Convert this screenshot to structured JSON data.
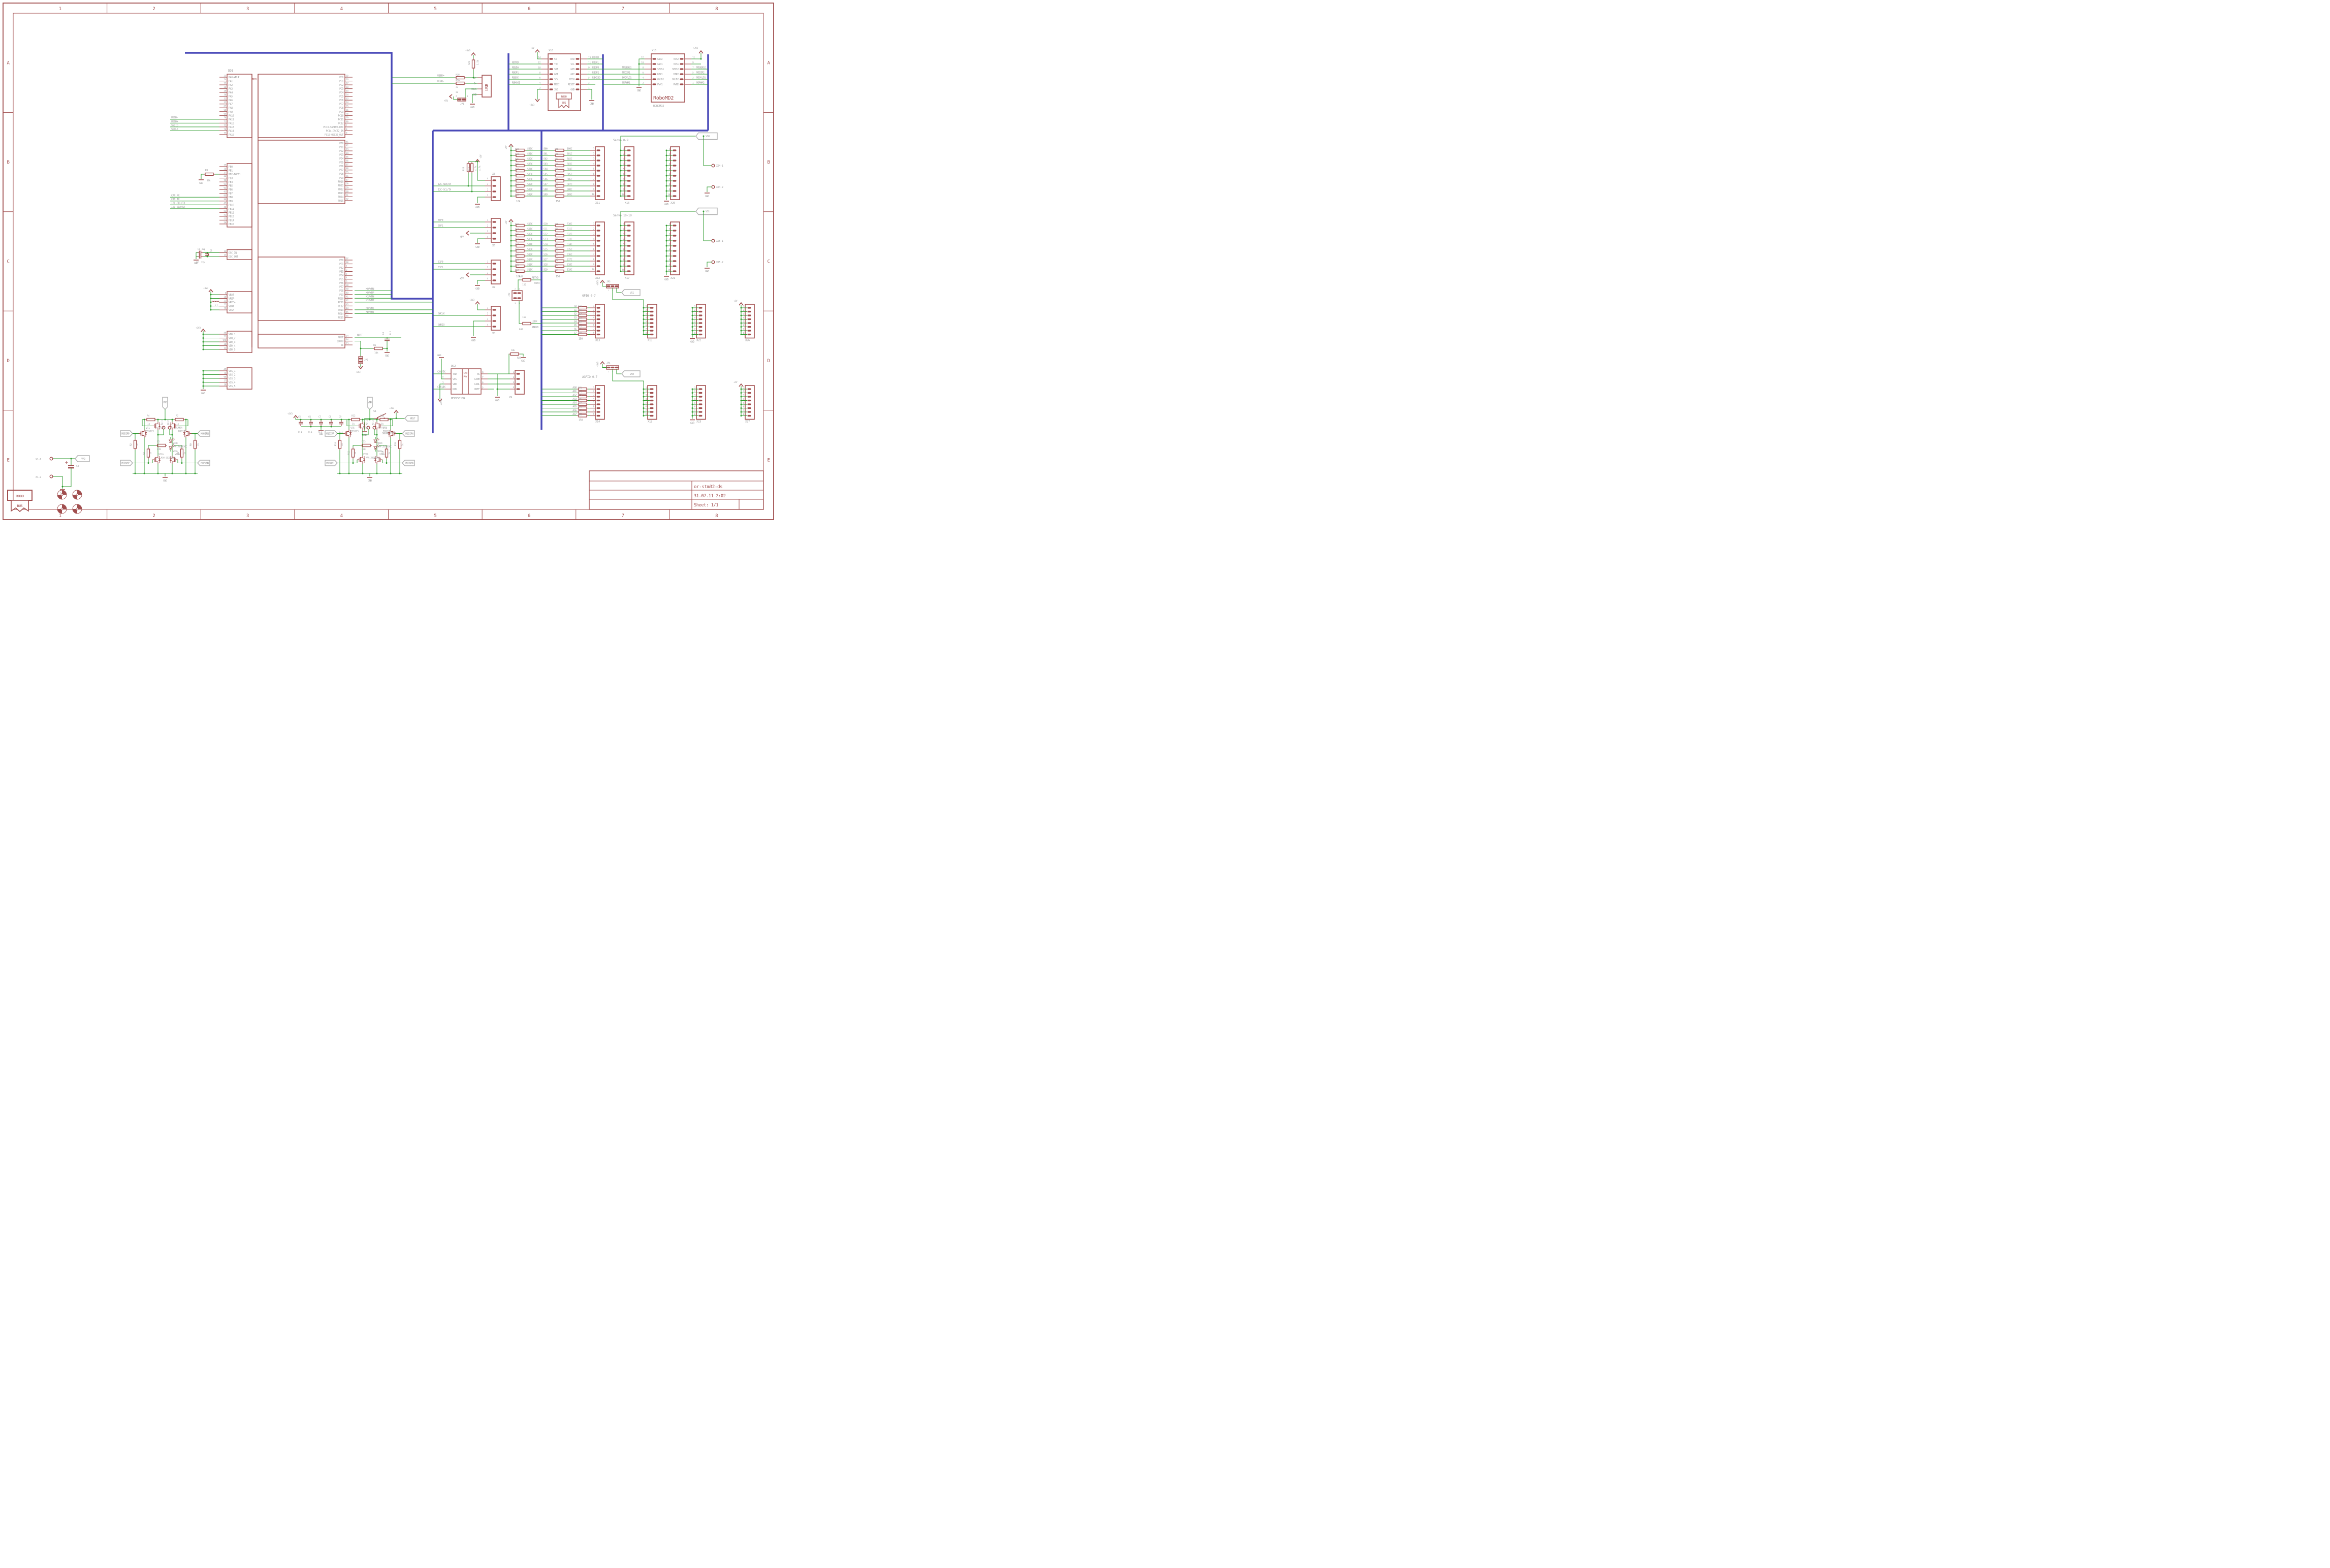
{
  "sym": {
    "gnd": "GND",
    "p5": "+5V",
    "p3": "+3V3",
    "vmd": "VMD"
  },
  "frame": {
    "cols": [
      "1",
      "2",
      "3",
      "4",
      "5",
      "6",
      "7",
      "8"
    ],
    "rows": [
      "A",
      "B",
      "C",
      "D",
      "E"
    ]
  },
  "title_block": {
    "project": "or-stm32-ds",
    "date": "31.07.11 2:02",
    "sheet": "Sheet: 1/1"
  },
  "mcu": {
    "name": "DD1",
    "tag": "MCU",
    "pa": [
      [
        "23",
        "PA0-WKUP",
        ""
      ],
      [
        "24",
        "PA1",
        ""
      ],
      [
        "25",
        "PA2",
        ""
      ],
      [
        "26",
        "PA3",
        ""
      ],
      [
        "29",
        "PA4",
        ""
      ],
      [
        "30",
        "PA5",
        ""
      ],
      [
        "31",
        "PA6",
        ""
      ],
      [
        "32",
        "PA7",
        ""
      ],
      [
        "67",
        "PA8",
        ""
      ],
      [
        "68",
        "PA9",
        ""
      ],
      [
        "69",
        "PA10",
        ""
      ],
      [
        "70",
        "PA11",
        "USBD-"
      ],
      [
        "71",
        "PA12",
        "USBD+"
      ],
      [
        "72",
        "PA13",
        "SWDIO"
      ],
      [
        "76",
        "PA14",
        "SWCLK"
      ],
      [
        "77",
        "PA15",
        ""
      ]
    ],
    "pb": [
      [
        "35",
        "PB0",
        ""
      ],
      [
        "36",
        "PB1",
        ""
      ],
      [
        "37",
        "PB2-BOOT1",
        ""
      ],
      [
        "89",
        "PB3",
        ""
      ],
      [
        "90",
        "PB4",
        ""
      ],
      [
        "91",
        "PB5",
        ""
      ],
      [
        "92",
        "PB6",
        ""
      ],
      [
        "93",
        "PB7",
        ""
      ],
      [
        "95",
        "PB8",
        "CAN_RX"
      ],
      [
        "96",
        "PB9",
        "CAN_TX"
      ],
      [
        "47",
        "PB10",
        "I2C-SCL/TX"
      ],
      [
        "48",
        "PB11",
        "I2C-SDA/RX"
      ],
      [
        "51",
        "PB12",
        ""
      ],
      [
        "52",
        "PB13",
        ""
      ],
      [
        "53",
        "PB14",
        ""
      ],
      [
        "54",
        "PB15",
        ""
      ]
    ],
    "pc": [
      [
        "15",
        "PC0"
      ],
      [
        "16",
        "PC1"
      ],
      [
        "17",
        "PC2"
      ],
      [
        "18",
        "PC3"
      ],
      [
        "33",
        "PC4"
      ],
      [
        "34",
        "PC5"
      ],
      [
        "63",
        "PC6"
      ],
      [
        "64",
        "PC7"
      ],
      [
        "65",
        "PC8"
      ],
      [
        "66",
        "PC9"
      ],
      [
        "78",
        "PC10"
      ],
      [
        "79",
        "PC11"
      ],
      [
        "80",
        "PC12"
      ],
      [
        "7",
        "PC13-TAMPER-RTC"
      ],
      [
        "8",
        "PC14-OSC32_IN"
      ],
      [
        "9",
        "PC15-OSC32_OUT"
      ]
    ],
    "pd": [
      [
        "81",
        "PD0"
      ],
      [
        "82",
        "PD1"
      ],
      [
        "83",
        "PD2"
      ],
      [
        "84",
        "PD3"
      ],
      [
        "85",
        "PD4"
      ],
      [
        "86",
        "PD5"
      ],
      [
        "87",
        "PD6"
      ],
      [
        "88",
        "PD7"
      ],
      [
        "55",
        "PD8"
      ],
      [
        "56",
        "PD9"
      ],
      [
        "57",
        "PD10"
      ],
      [
        "58",
        "PD11"
      ],
      [
        "59",
        "PD12"
      ],
      [
        "60",
        "PD13"
      ],
      [
        "61",
        "PD14"
      ],
      [
        "62",
        "PD15"
      ]
    ],
    "pe": [
      [
        "97",
        "PE0",
        ""
      ],
      [
        "98",
        "PE1",
        ""
      ],
      [
        "1",
        "PE2",
        ""
      ],
      [
        "2",
        "PE3",
        ""
      ],
      [
        "3",
        "PE4",
        ""
      ],
      [
        "4",
        "PE5",
        ""
      ],
      [
        "5",
        "PE6",
        ""
      ],
      [
        "38",
        "PE7",
        ""
      ],
      [
        "39",
        "PE8",
        "M0PWMN"
      ],
      [
        "40",
        "PE9",
        "M0PWMP"
      ],
      [
        "41",
        "PE10",
        "M1PWMN"
      ],
      [
        "42",
        "PE11",
        "M1PWMP"
      ],
      [
        "43",
        "PE12",
        ""
      ],
      [
        "44",
        "PE13",
        "MDPWM1"
      ],
      [
        "45",
        "PE14",
        "MDPWM2"
      ],
      [
        "46",
        "PE15",
        ""
      ]
    ],
    "osc": [
      [
        "12",
        "OSC_IN"
      ],
      [
        "13",
        "OSC_OUT"
      ]
    ],
    "pwr": [
      [
        "6",
        "VBAT"
      ],
      [
        "20",
        "VREF-"
      ],
      [
        "21",
        "VREF+"
      ],
      [
        "22",
        "VDDA"
      ],
      [
        "19",
        "VSSA"
      ]
    ],
    "vdd": [
      [
        "50",
        "VDD_1"
      ],
      [
        "75",
        "VDD_2"
      ],
      [
        "100",
        "VDD_3"
      ],
      [
        "28",
        "VDD_4"
      ],
      [
        "11",
        "VDD_5"
      ]
    ],
    "vss": [
      [
        "49",
        "VSS_1"
      ],
      [
        "74",
        "VSS_2"
      ],
      [
        "99",
        "VSS_3"
      ],
      [
        "27",
        "VSS_4"
      ],
      [
        "10",
        "VSS_5"
      ]
    ],
    "sys": [
      [
        "14",
        "NRST"
      ],
      [
        "94",
        "BOOT0"
      ],
      [
        "73",
        "NC"
      ]
    ]
  },
  "osc_parts": {
    "c1": "C1",
    "c1v": "22p",
    "c2": "C2",
    "c2v": "22p",
    "q1": "Q1",
    "l1": "L1",
    "r1": "R1",
    "r1v": "10k"
  },
  "reset": {
    "nrst": "NRST",
    "c4": "C4",
    "c4v": "0.1",
    "r6": "R6",
    "r6v": "10k",
    "jp5": "JP5",
    "s1": "S1",
    "s1v": "SKHMPSE010"
  },
  "decap": {
    "names": [
      "C5",
      "C6",
      "C7",
      "C8",
      "C9"
    ],
    "value": "0.1"
  },
  "usb": {
    "conn": "USB",
    "pins": [
      "D+",
      "D-",
      "VBUS",
      "GND"
    ],
    "r18": "R18",
    "r18v": "22",
    "r19": "R19",
    "r19v": "22",
    "r21": "R21",
    "r21v": "1.5k",
    "jp1": "JP1",
    "jp1_pins": [
      "2",
      "1"
    ],
    "netp": "USBD+",
    "netn": "USBD-"
  },
  "x10": {
    "name": "X10",
    "badge1": "ROBO",
    "badge2": "BUS",
    "left": [
      [
        "14",
        "5V",
        ""
      ],
      [
        "12",
        "TXD",
        "RBTXD"
      ],
      [
        "10",
        "SDA",
        "RBSDA"
      ],
      [
        "8",
        "GP1",
        "RBGP1"
      ],
      [
        "6",
        "SCK",
        "RBSCK"
      ],
      [
        "4",
        "MOSI",
        "RBMOSI"
      ],
      [
        "2",
        "3V3",
        ""
      ]
    ],
    "right": [
      [
        "13",
        "RXD",
        "RBRXD"
      ],
      [
        "11",
        "SCL",
        "RBSCL"
      ],
      [
        "9",
        "GP0",
        "RBGP0"
      ],
      [
        "7",
        "GP2",
        "RBGP2"
      ],
      [
        "5",
        "MISO",
        "RBMISO"
      ],
      [
        "3",
        "RESET",
        ""
      ],
      [
        "1",
        "GND",
        ""
      ]
    ]
  },
  "x15": {
    "name": "X15",
    "big": "RoboMD2",
    "sub": "ROBOMD2",
    "left": [
      [
        "12",
        "GND2",
        ""
      ],
      [
        "10",
        "GND1",
        ""
      ],
      [
        "8",
        "SENS1",
        "MDSENS1"
      ],
      [
        "6",
        "DIR1",
        "MDDIR1"
      ],
      [
        "4",
        "OVLD1",
        "DMOVLD1"
      ],
      [
        "2",
        "PWM1",
        "MDPWM1"
      ]
    ],
    "right": [
      [
        "11",
        "VSS2",
        ""
      ],
      [
        "9",
        "VSS1",
        ""
      ],
      [
        "7",
        "SENS2",
        "MDSENS2"
      ],
      [
        "5",
        "DIR2",
        "MDDIR2"
      ],
      [
        "3",
        "OVLD2",
        "MDOVLD2"
      ],
      [
        "1",
        "PWM2",
        "MDPWM2"
      ]
    ]
  },
  "servo09": {
    "title": "Servo 0-9",
    "pull": [
      "R23",
      "R24",
      "R25",
      "R26",
      "R27",
      "R28",
      "R29",
      "R30",
      "R31",
      "R32"
    ],
    "pull_v": "10k",
    "series": [
      "R45",
      "R46",
      "R47",
      "R48",
      "R49",
      "R50",
      "R51",
      "R52",
      "R53",
      "R54"
    ],
    "series_v": "150",
    "c_nets": [
      "S00C",
      "S01C",
      "S02C",
      "S03C",
      "S04C",
      "S05C",
      "S06C",
      "S07C",
      "S08C",
      "S09C"
    ],
    "nets": [
      "S00",
      "S01",
      "S02",
      "S03",
      "S04",
      "S05",
      "S06",
      "S07",
      "S08",
      "S09"
    ],
    "conn": "X11",
    "rail": "X16",
    "gndc": "X20",
    "pins": [
      "1",
      "2",
      "3",
      "4",
      "5",
      "6",
      "7",
      "8",
      "9",
      "10"
    ],
    "vs": "VS0",
    "pad1": "X24-1",
    "pad2": "X24-2"
  },
  "servo1019": {
    "title": "Servo 10-19",
    "pull": [
      "R33",
      "R34",
      "R35",
      "R36",
      "R37",
      "R38",
      "R39",
      "R40",
      "R41",
      "R42"
    ],
    "pull_v": "10k",
    "series": [
      "R55",
      "R56",
      "R57",
      "R58",
      "R59",
      "R60",
      "R61",
      "R62",
      "R63",
      "R64"
    ],
    "series_v": "150",
    "c_nets": [
      "S10C",
      "S11C",
      "S12C",
      "S13C",
      "S14C",
      "S15C",
      "S16C",
      "S17C",
      "S18C",
      "S19C"
    ],
    "nets": [
      "S10",
      "S11",
      "S12",
      "S13",
      "S14",
      "S15",
      "S16",
      "S17",
      "S18",
      "S19"
    ],
    "conn": "X12",
    "rail": "X17",
    "gndc": "X21",
    "pins": [
      "1",
      "2",
      "3",
      "4",
      "5",
      "6",
      "7",
      "8",
      "9",
      "10"
    ],
    "vs": "VS1",
    "pad1": "X25-1",
    "pad2": "X25-2"
  },
  "uart": {
    "r43": "R43",
    "r43v": "150",
    "r43a": "RBTXD",
    "r43b": "U2TX",
    "r44": "R44",
    "r44v": "150",
    "r44a": "U2RX",
    "r44b": "RBRXD",
    "jp2": "JP2",
    "jp2_pins": [
      "2",
      "4",
      "1",
      "3"
    ]
  },
  "aux": {
    "x5": {
      "name": "X5",
      "pins": [
        [
          "4",
          "+5V"
        ],
        [
          "3",
          "I2C-SDA/RX"
        ],
        [
          "2",
          "I2C-SCL/TX"
        ],
        [
          "1",
          "GND"
        ]
      ],
      "r16": "R16",
      "r16v": "4.7k",
      "r17": "R17",
      "r17v": "4.7k"
    },
    "x6": {
      "name": "X6",
      "pins": [
        [
          "1",
          "E0F0"
        ],
        [
          "2",
          "E0F1"
        ],
        [
          "3",
          "+5V"
        ],
        [
          "4",
          "GND"
        ]
      ]
    },
    "x7": {
      "name": "X7",
      "pins": [
        [
          "1",
          "E1F0"
        ],
        [
          "2",
          "E1F1"
        ],
        [
          "3",
          "+5V"
        ],
        [
          "4",
          "GND"
        ]
      ]
    },
    "x8": {
      "name": "X8",
      "pins": [
        [
          "1",
          "+3V3"
        ],
        [
          "2",
          "SWCLK"
        ],
        [
          "3",
          "GND"
        ],
        [
          "4",
          "SWDIO"
        ]
      ]
    }
  },
  "can": {
    "name": "DD2",
    "value": "MCP2551SN",
    "tag1": "CAN",
    "tag2": "PHY",
    "left": [
      [
        "1",
        "TXD",
        "CAN_TX"
      ],
      [
        "2",
        "VSS",
        ""
      ],
      [
        "3",
        "VDD",
        ""
      ],
      [
        "4",
        "RXD",
        "CAN_RX"
      ]
    ],
    "right": [
      [
        "8",
        "RS"
      ],
      [
        "7",
        "CANH"
      ],
      [
        "6",
        "CANL"
      ],
      [
        "5",
        "VREF"
      ]
    ],
    "r22": "R22",
    "r22v": "10k",
    "x9": "X9",
    "x9_pins": [
      "1",
      "2",
      "3",
      "4"
    ]
  },
  "gpio": {
    "title": "GPIO 0-7",
    "nets": [
      "G0",
      "G1",
      "G2",
      "G3",
      "G4",
      "G5",
      "G6",
      "G7"
    ],
    "res": [
      "R65",
      "R66",
      "R67",
      "R68",
      "R69",
      "R70",
      "R71",
      "R72"
    ],
    "res_v": "150",
    "conn": "X13",
    "rail": "X18",
    "gndc": "X22",
    "pwrc": "X26",
    "pins": [
      "1",
      "2",
      "3",
      "4",
      "5",
      "6",
      "7",
      "8"
    ],
    "jp": "JP3",
    "jp_pins": [
      "1",
      "2",
      "3"
    ],
    "vs": "VS1"
  },
  "agpio": {
    "title": "AGPIO 0-7",
    "nets": [
      "AG0",
      "AG1",
      "AG2",
      "AG3",
      "AG4",
      "AG5",
      "AG6",
      "AG7"
    ],
    "res": [
      "R73",
      "R74",
      "R75",
      "R76",
      "R77",
      "R78",
      "R79",
      "R80"
    ],
    "res_v": "150",
    "conn": "X14",
    "rail": "X19",
    "gndc": "X23",
    "pwrc": "X27",
    "pins": [
      "1",
      "2",
      "3",
      "4",
      "5",
      "6",
      "7",
      "8"
    ],
    "jp": "JP4",
    "jp_pins": [
      "1",
      "2",
      "3"
    ],
    "vs": "VS0"
  },
  "motor0": {
    "dirp": "M0DIRP",
    "dirn": "M0DIRN",
    "pwmp": "M0PWMP",
    "pwmn": "M0PWMN",
    "rt1": "R4",
    "rt2": "R7",
    "rt_v": "1k",
    "rg1": "R2",
    "rg2": "R9",
    "rm1": "R3",
    "rm2": "R8",
    "r_v": "1k",
    "r5": "R5",
    "r5v": "820",
    "t1": "VT1",
    "t1v": "BSS123",
    "t2": "VT4",
    "t2v": "BSS123",
    "ab": [
      "VT2B",
      "VT3B",
      "VT2A",
      "VT3A"
    ],
    "led1": "VD1R",
    "led2": "VD1G",
    "ledv": "KAA-3528ESGC",
    "pad1": "X2-1",
    "pad2": "X2-2"
  },
  "motor1": {
    "dirp": "M1DIRP",
    "dirn": "M1DIRN",
    "pwmp": "M1PWMP",
    "pwmn": "M1PWMN",
    "rt1": "R12",
    "rt2": "R14",
    "rt_v": "1k",
    "rg1": "R10",
    "rg2": "R20",
    "rm1": "R11",
    "rm2": "R19",
    "r_v": "1k",
    "r5": "R13",
    "r5v": "820",
    "t1": "VT5",
    "t1v": "BSS123",
    "t2": "VT8",
    "t2v": "BSS123",
    "ab": [
      "VT6B",
      "VT7B",
      "VT6A",
      "VT7A"
    ],
    "led1": "VD2R",
    "led2": "VD2G",
    "ledv": "KAA-3528ESGC",
    "pad1": "X3-1",
    "pad2": "X3-2"
  },
  "power_in": {
    "p1": "X1-1",
    "p2": "X1-2",
    "c3": "C3",
    "logo1": "ROBO",
    "logo2": "BUS"
  }
}
